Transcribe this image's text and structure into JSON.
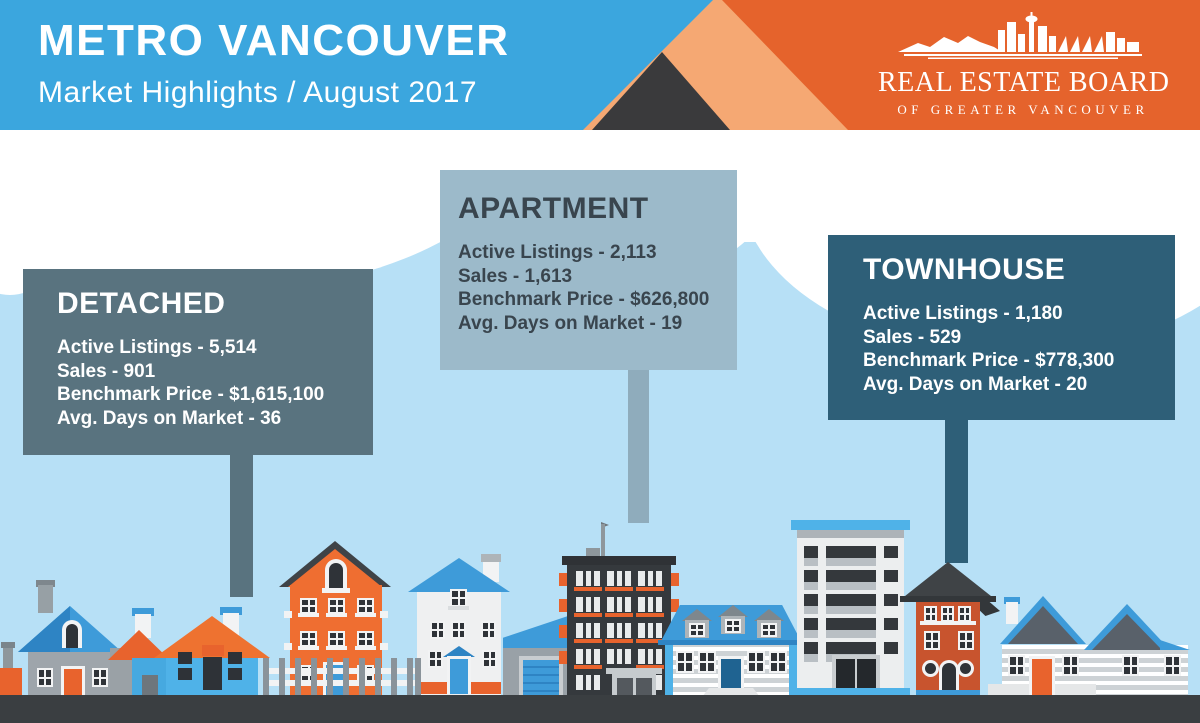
{
  "header": {
    "title": "METRO VANCOUVER",
    "subtitle": "Market Highlights / August 2017",
    "logo_name": "REAL ESTATE BOARD",
    "logo_tagline": "OF GREATER VANCOUVER"
  },
  "cards": [
    {
      "id": "detached",
      "title": "DETACHED",
      "stats": [
        "Active Listings - 5,514",
        "Sales - 901",
        "Benchmark Price - $1,615,100",
        "Avg. Days on Market - 36"
      ]
    },
    {
      "id": "apartment",
      "title": "APARTMENT",
      "stats": [
        "Active Listings - 2,113",
        "Sales - 1,613",
        "Benchmark Price - $626,800",
        "Avg. Days on Market - 19"
      ]
    },
    {
      "id": "townhouse",
      "title": "TOWNHOUSE",
      "stats": [
        "Active Listings - 1,180",
        "Sales - 529",
        "Benchmark Price - $778,300",
        "Avg. Days on Market - 20"
      ]
    }
  ],
  "colors": {
    "header_blue": "#3BA6DE",
    "brand_orange": "#E5632C",
    "brand_peach": "#F5A873",
    "brand_dark": "#3A3A3C",
    "sky_blue": "#B7E0F6",
    "cloud_white": "#FFFFFF",
    "card_detached_bg": "#59737F",
    "card_apartment_bg": "#9CBACA",
    "card_apartment_text": "#39454E",
    "card_townhouse_bg": "#2E5F78",
    "card_light_text": "#FFFFFF",
    "ground_dark": "#3A3E41",
    "roof_blue": "#3E9BD9",
    "accent_orange": "#E8632D"
  }
}
